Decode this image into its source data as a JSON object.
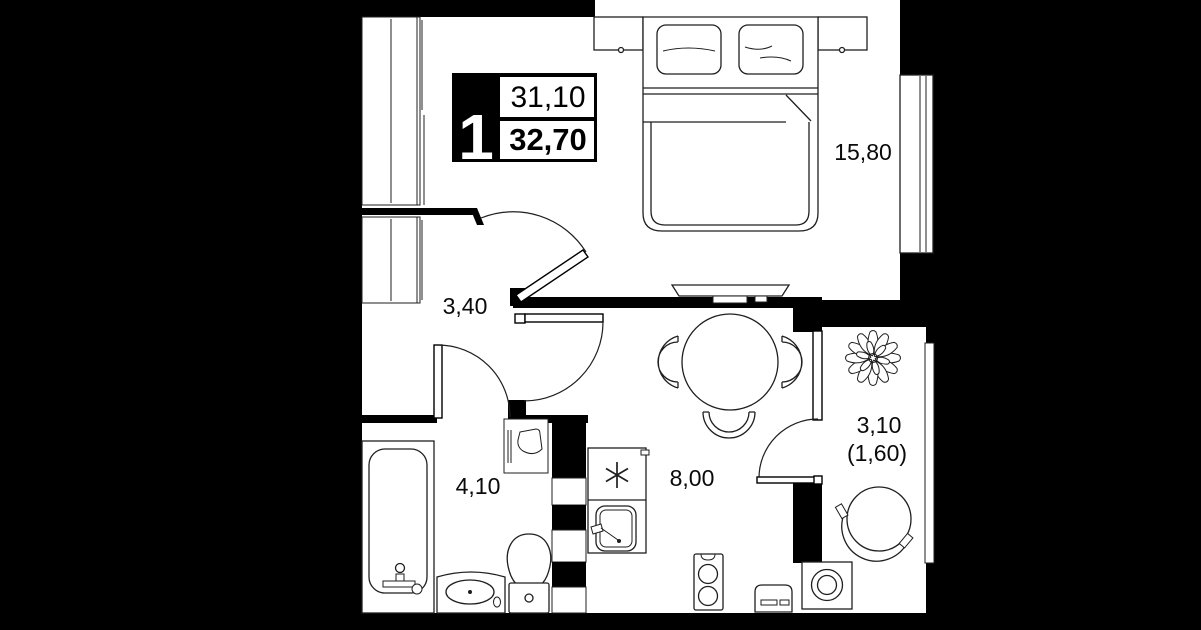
{
  "window": {
    "width": 1201,
    "height": 630
  },
  "colors": {
    "background": "#000000",
    "walls": "#000000",
    "floor": "#ffffff",
    "furniture_line": "#1f1f1f",
    "label_text": "#0a0a0a",
    "badge_background": "#000000",
    "badge_number_color": "#ffffff"
  },
  "badge": {
    "rooms_count": "1",
    "upper_area": "31,10",
    "lower_area": "32,70"
  },
  "room_labels": {
    "bedroom": "15,80",
    "hallway": "3,40",
    "bathroom": "4,10",
    "kitchen": "8,00",
    "balcony_total": "3,10",
    "balcony_reduced": "(1,60)"
  },
  "icons": [
    "double-bed-icon",
    "pillow-icon",
    "nightstand-icon",
    "tv-icon",
    "wardrobe-icon",
    "closet-icon",
    "dining-table-icon",
    "chair-icon",
    "plant-icon",
    "round-chair-icon",
    "washing-machine-icon",
    "bathtub-icon",
    "vanity-sink-icon",
    "toilet-icon",
    "water-heater-icon",
    "stove-icon",
    "kitchen-sink-icon",
    "two-burner-cooktop-icon",
    "appliance-icon",
    "vent-shaft-icon",
    "window-icon",
    "door-icon",
    "entrance-door-icon"
  ]
}
